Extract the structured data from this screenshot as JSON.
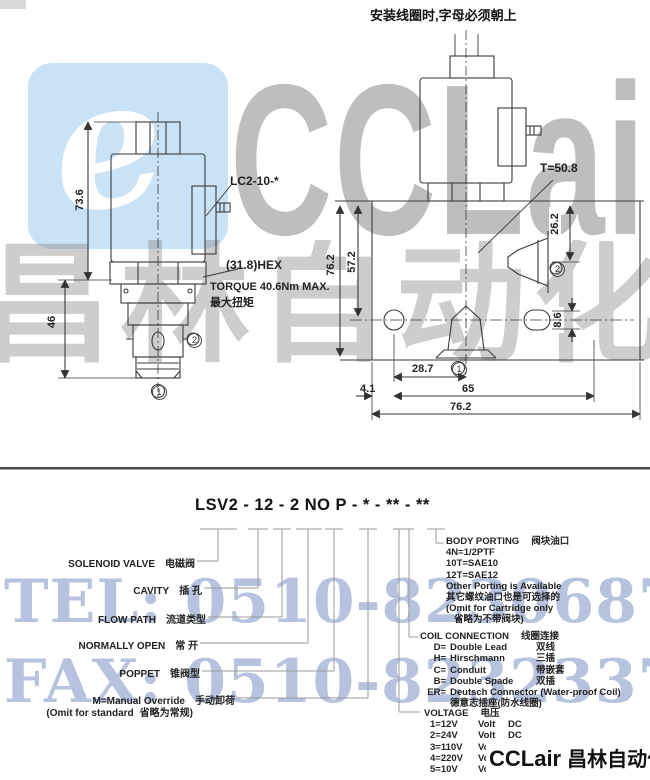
{
  "note_top": "安装线圈时,字母必须朝上",
  "model_code": "LSV2 - 12 - 2 NO P - * - ** - **",
  "drawing_left": {
    "coil_connector_label": "LC2-10-*",
    "hex_label": "(31.8)HEX",
    "torque_line1": "TORQUE 40.6Nm MAX.",
    "torque_line2": "最大扭矩",
    "dim_coil_height": "73.6",
    "dim_cartridge_height": "46",
    "port1": "1",
    "port2": "2"
  },
  "drawing_right": {
    "thread_label": "T=50.8",
    "dim_port_depth": "26.2",
    "dim_block_height": "76.2",
    "dim_hole_depth": "57.2",
    "dim_slot_height": "8.6",
    "dim_offset": "28.7",
    "dim_hole_span": "65",
    "dim_edge": "4.1",
    "dim_block_width": "76.2",
    "port1": "1",
    "port2": "2"
  },
  "left_labels": [
    {
      "en": "SOLENOID VALVE",
      "zh": "电磁阀"
    },
    {
      "en": "CAVITY",
      "zh": "插 孔"
    },
    {
      "en": "FLOW PATH",
      "zh": "流道类型"
    },
    {
      "en": "NORMALLY OPEN",
      "zh": "常 开"
    },
    {
      "en": "POPPET",
      "zh": "锥阀型"
    },
    {
      "en": "M=Manual Override",
      "zh": "手动卸荷"
    },
    {
      "en": "(Omit for standard",
      "zh": "省略为常规)"
    }
  ],
  "body_porting": {
    "title_en": "BODY PORTING",
    "title_zh": "阀块油口",
    "line1": "4N=1/2PTF",
    "line2": "10T=SAE10",
    "line3": "12T=SAE12",
    "line4": "Other Porting is Available",
    "line5": "其它螺纹油口也是可选择的",
    "line6": "(Omit for Cartridge only",
    "line7": "省略为不带阀块)"
  },
  "coil_connection": {
    "title_en": "COIL CONNECTION",
    "title_zh": "线圈连接",
    "items": [
      {
        "code": "D=",
        "name": "Double Lead",
        "zh": "双线"
      },
      {
        "code": "H=",
        "name": "Hirschmann",
        "zh": "三插"
      },
      {
        "code": "C=",
        "name": "Conduit",
        "zh": "带嵌套"
      },
      {
        "code": "B=",
        "name": "Double Spade",
        "zh": "双插"
      },
      {
        "code": "ER=",
        "name": "Deutsch Connector (Water-proof Coil)",
        "zh": ""
      }
    ],
    "note_zh": "德意志插座(防水线圈)"
  },
  "voltage": {
    "title_en": "VOLTAGE",
    "title_zh": "电压",
    "items": [
      {
        "code": "1=12V",
        "unit": "Volt",
        "type": "DC"
      },
      {
        "code": "2=24V",
        "unit": "Volt",
        "type": "DC"
      },
      {
        "code": "3=110V",
        "unit": "Volt",
        "type": "AC"
      },
      {
        "code": "4=220V",
        "unit": "Volt",
        "type": "AC"
      },
      {
        "code": "5=10V",
        "unit": "Volt",
        "type": "DC"
      }
    ]
  },
  "watermark": {
    "brand": "CCLair",
    "company_cn": "昌林自动化",
    "swirl_glyph": "e",
    "tel": "TEL: 0510-82306871",
    "fax": "FAX: 0510-82323371",
    "blue": "#c9e2f6",
    "tel_blue": "#6880ba",
    "gray": "#7d7d7d"
  },
  "logo_bottom": {
    "brand": "CCLair",
    "company": "昌林自动化"
  }
}
